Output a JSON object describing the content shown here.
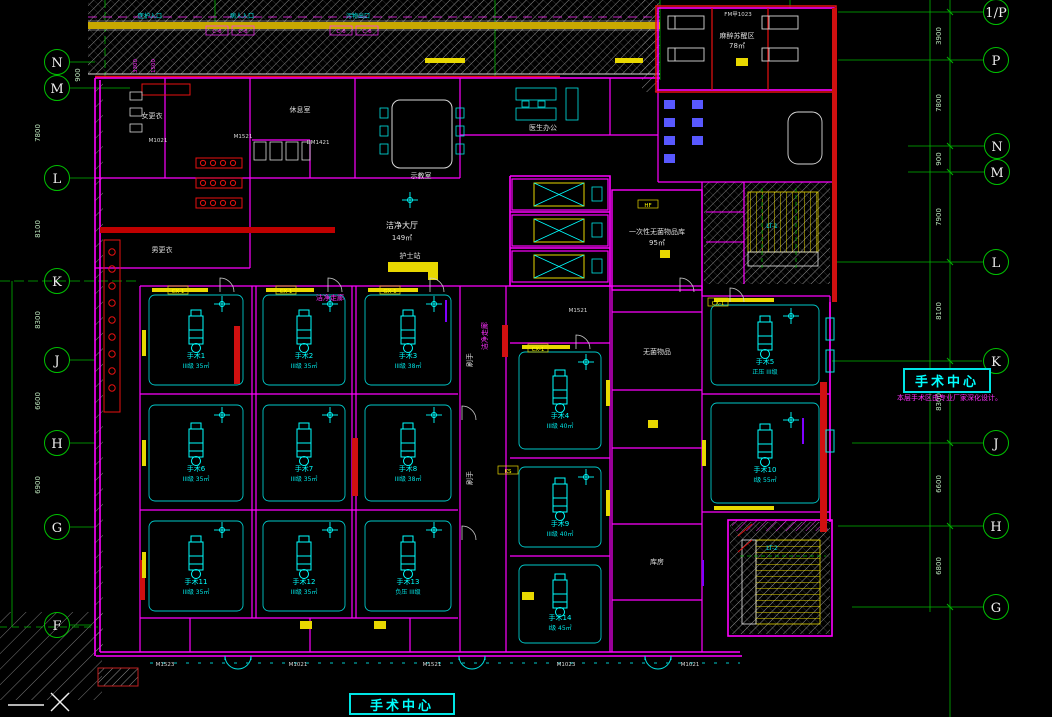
{
  "drawing": {
    "kind": "CAD floor plan - hospital surgical department",
    "floor_title": "手术中心",
    "side_title": "手术中心",
    "side_note": "本层手术区由专业厂家深化设计。"
  },
  "palette": {
    "background": "#000000",
    "grid_green": "#00c000",
    "wall_magenta": "#ff00ff",
    "accent_red": "#e81010",
    "fixture_cyan": "#00ffff",
    "equipment_yellow": "#ffff00",
    "text_white": "#e0e0e0",
    "hatch_gray": "#8f8f8f",
    "furniture_blue": "#5858ff"
  },
  "grid": {
    "left": [
      "N",
      "M",
      "L",
      "K",
      "J",
      "H",
      "G",
      "F"
    ],
    "right": [
      "1/P",
      "P",
      "N",
      "M",
      "L",
      "K",
      "J",
      "H",
      "G"
    ],
    "dims_right": [
      "3900",
      "7800",
      "900",
      "7900",
      "8100",
      "8300",
      "6600",
      "6800"
    ],
    "dims_left": [
      "900",
      "7800",
      "8100",
      "8300",
      "6600",
      "6900"
    ],
    "dims_top": [
      "3300",
      "1500"
    ]
  },
  "rooms": {
    "hall": {
      "name": "洁净大厅",
      "area": "149㎡"
    },
    "recovery": {
      "name": "麻醉苏醒区",
      "area": "78㎡"
    },
    "sterile_store": {
      "name": "一次性无菌物品库",
      "area": "95㎡"
    },
    "teaching": "示教室",
    "office": "医生办公",
    "rest": "休息室",
    "dress_f": "女更衣",
    "dress_m": "男更衣",
    "nurse": "护士站",
    "scrub1": "刷手",
    "scrub2": "刷手",
    "corridor1": "洁净走廊",
    "corridor2": "洁净走廊",
    "instrument": "无菌物品",
    "storage": "库房",
    "stair1": "LT-1",
    "stair2": "LT-2",
    "entr_staff": "医护入口",
    "entr_patient": "病人入口",
    "exit_soiled": "污物出口"
  },
  "operating_rooms": [
    {
      "name": "手术1",
      "info": "III级 35㎡"
    },
    {
      "name": "手术2",
      "info": "III级 35㎡"
    },
    {
      "name": "手术3",
      "info": "III级 38㎡"
    },
    {
      "name": "手术4",
      "info": "III级 40㎡"
    },
    {
      "name": "手术5",
      "info": "正压 III级"
    },
    {
      "name": "手术6",
      "info": "III级 35㎡"
    },
    {
      "name": "手术7",
      "info": "III级 35㎡"
    },
    {
      "name": "手术8",
      "info": "III级 38㎡"
    },
    {
      "name": "手术9",
      "info": "III级 40㎡"
    },
    {
      "name": "手术10",
      "info": "I级 55㎡"
    },
    {
      "name": "手术11",
      "info": "III级 35㎡"
    },
    {
      "name": "手术12",
      "info": "III级 35㎡"
    },
    {
      "name": "手术13",
      "info": "负压 III级"
    },
    {
      "name": "手术14",
      "info": "I级 45㎡"
    }
  ],
  "door_codes": [
    "FM甲1023",
    "M1021",
    "M1521",
    "DM1421",
    "M1521",
    "M1523",
    "M1021",
    "M1521",
    "M1023",
    "M1021"
  ],
  "equip_codes": [
    "CX-1",
    "CX-1",
    "GX-1",
    "CX-1",
    "CX-1",
    "HF",
    "KS"
  ],
  "window_codes": [
    "C-6",
    "C-6",
    "C-6",
    "C-6"
  ]
}
